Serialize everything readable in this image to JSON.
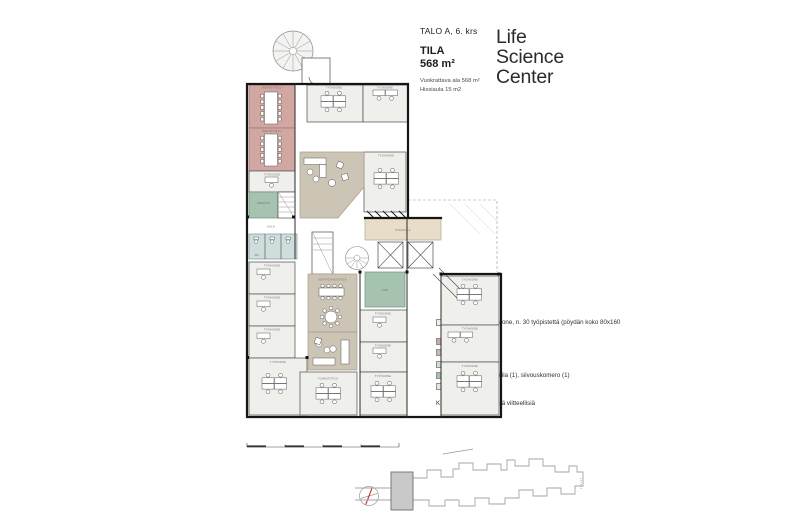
{
  "header": {
    "building": "TALO A, 6. krs",
    "space_label": "TILA",
    "area": "568 m²",
    "rentable": "Vuokrattava ala 568 m²",
    "lobby": "Hissiaula 15 m2"
  },
  "logo": {
    "line1": "Life",
    "line2": "Science",
    "line3": "Center"
  },
  "legend": {
    "items": [
      {
        "label": "Toimistotila ja työhuone, n. 30 työpistettä (pöydän koko 80x160 cm)",
        "color": "#eff0ec"
      },
      {
        "label": "Neuvottelu (2)",
        "color": "#d2a7a2"
      },
      {
        "label": "Keittiö/taukotila (1)",
        "color": "#c6bcae"
      },
      {
        "label": "WC (3)",
        "color": "#cfdedd"
      },
      {
        "label": "Varasto (1), serveritila (1), siivouskomero (1)",
        "color": "#a6c3b0"
      },
      {
        "label": "Hissiaula",
        "color": "#efe3da"
      }
    ],
    "note": "Kalustus ja henkilömäärä viitteellisiä"
  },
  "plan": {
    "labels": {
      "neuvottelu": "NEUVOTTELU",
      "tyohuone": "TYÖHUONE",
      "varasto": "VARASTO",
      "var": "VAR",
      "wc": "WC",
      "aula": "AULA",
      "hissiaula": "HISSIAULA",
      "keittio": "KEITTIÖ/TAUKOTILA",
      "toimistotila": "TOIMISTOTILA"
    }
  }
}
